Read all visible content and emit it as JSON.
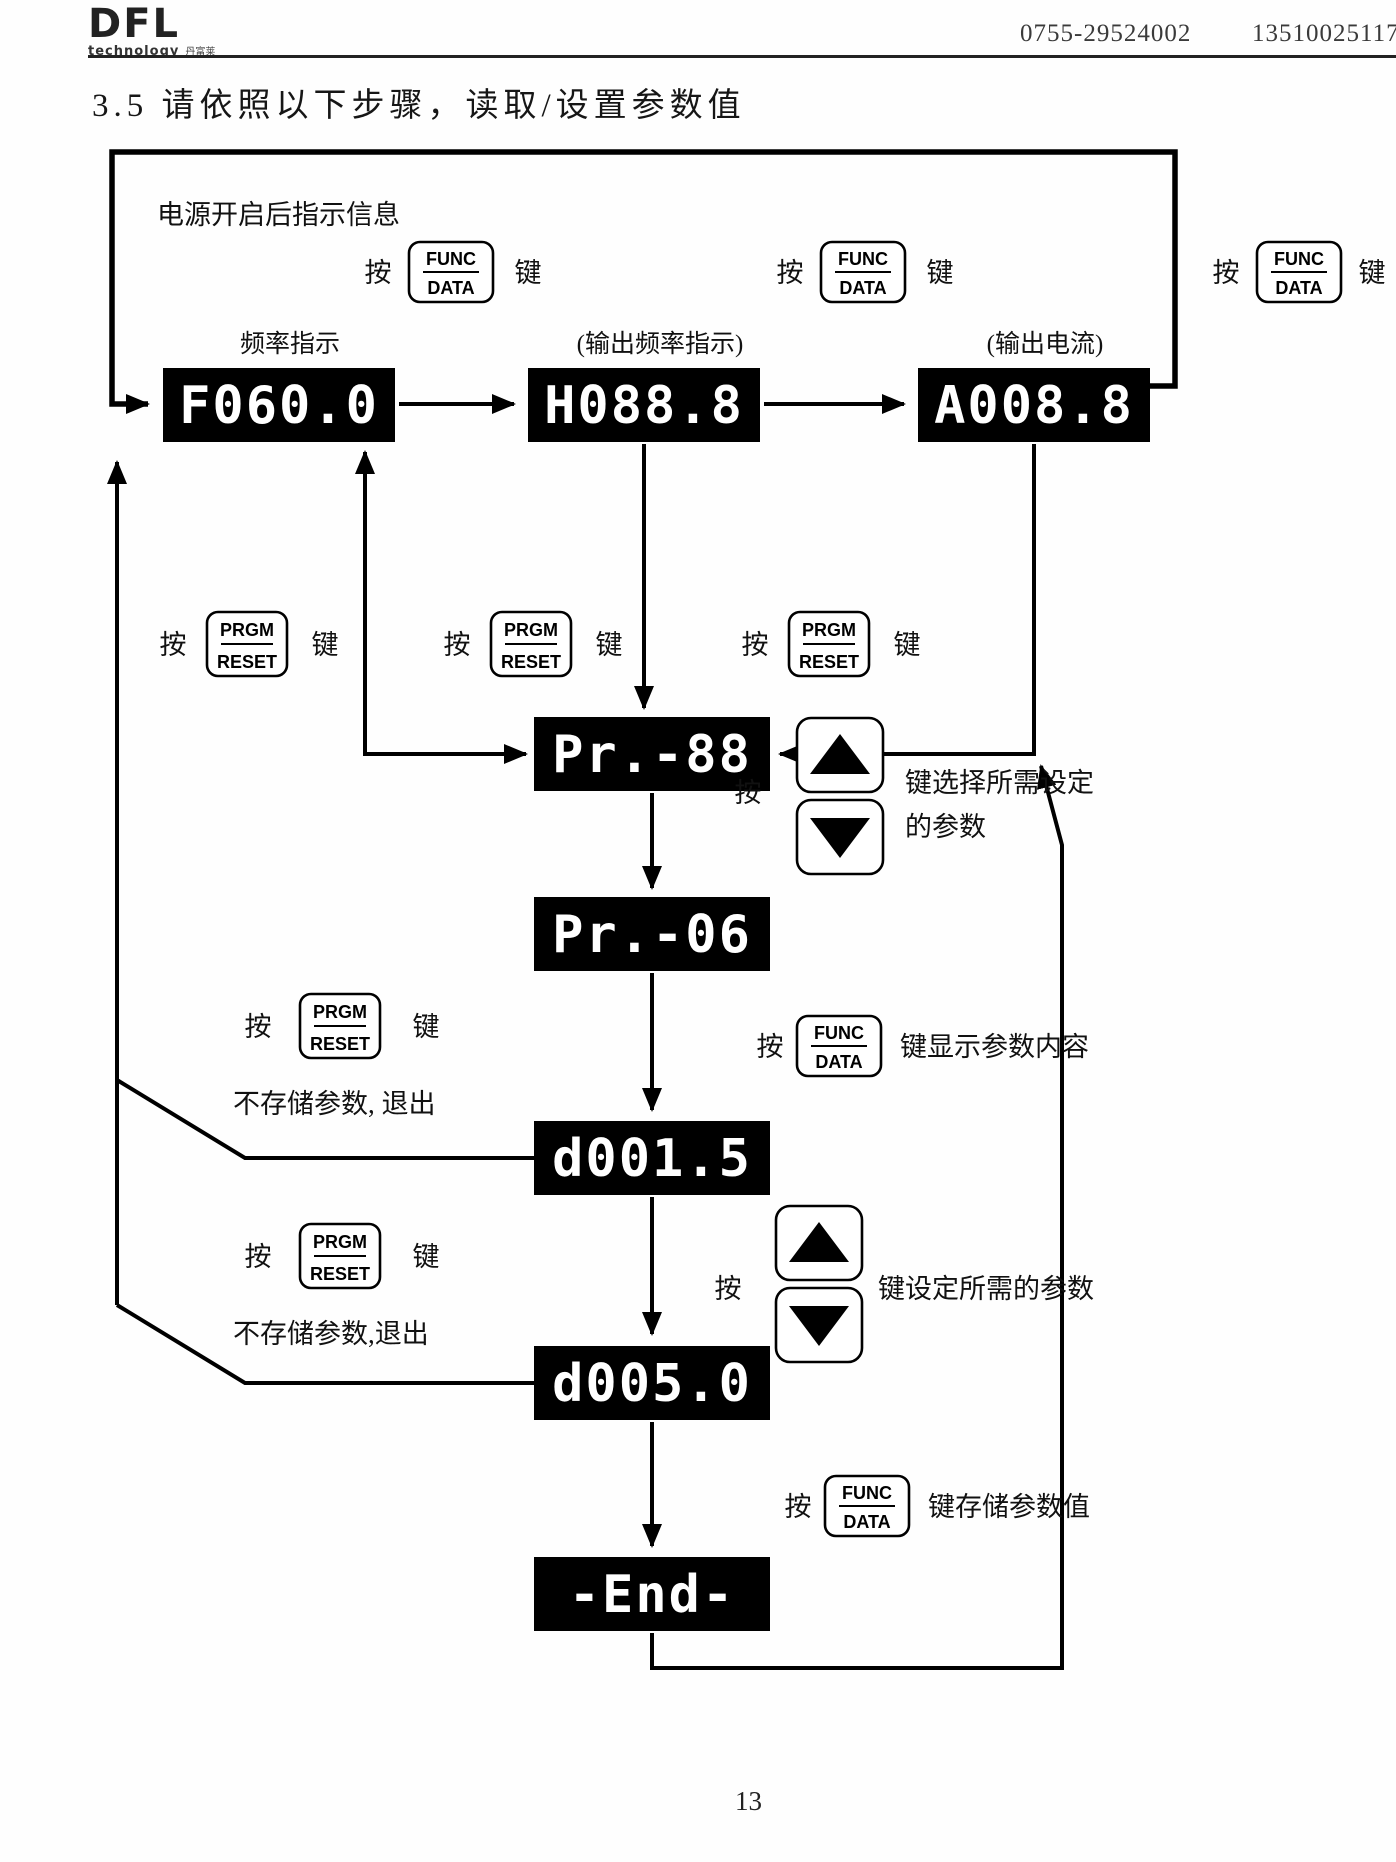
{
  "header": {
    "logo_main": "DFL",
    "logo_sub": "technology",
    "logo_cn": "丹富莱",
    "phone_left": "0755-29524002",
    "phone_right": "13510025117"
  },
  "title": "3.5 请依照以下步骤，读取/设置参数值",
  "footer": {
    "page_number": "13"
  },
  "diagram": {
    "power_on_note": "电源开启后指示信息",
    "press": "按",
    "key": "键",
    "keys": {
      "func_top": "FUNC",
      "func_bottom": "DATA",
      "prgm_top": "PRGM",
      "prgm_bottom": "RESET"
    },
    "displays": {
      "freq_label": "频率指示",
      "freq_value": "F060.0",
      "out_freq_label": "(输出频率指示)",
      "out_freq_value": "H088.8",
      "out_current_label": "(输出电流)",
      "out_current_value": "A008.8",
      "param_group_value": "Pr.-88",
      "param_select_value": "Pr.-06",
      "param_content_value": "d001.5",
      "param_set_value": "d005.0",
      "end_value": "-End-"
    },
    "notes": {
      "select_param_1": "键选择所需设定",
      "select_param_2": "的参数",
      "show_content": "键显示参数内容",
      "set_param": "键设定所需的参数",
      "save_param": "键存储参数值",
      "no_save_exit_1": "不存储参数, 退出",
      "no_save_exit_2": "不存储参数,退出"
    }
  }
}
